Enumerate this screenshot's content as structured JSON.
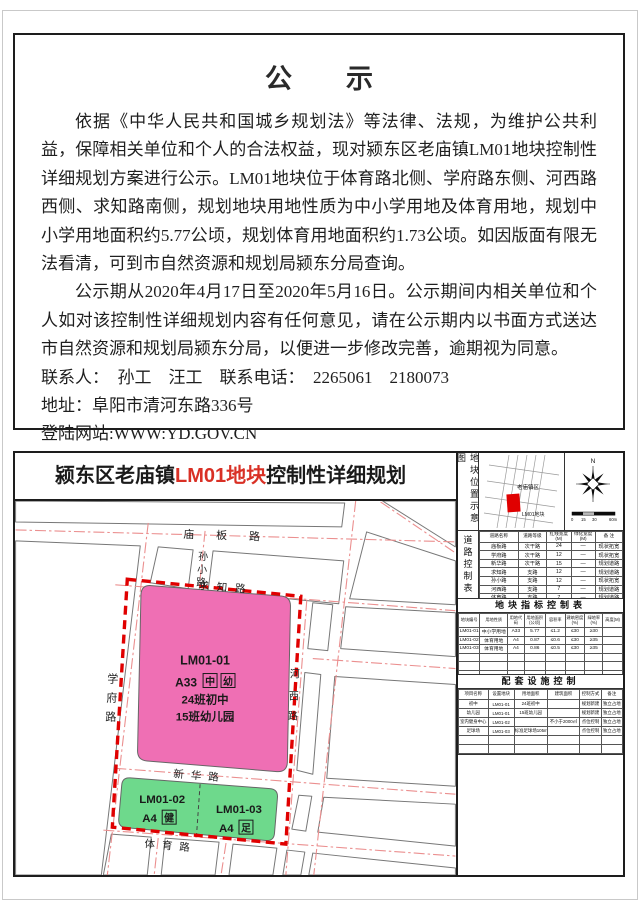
{
  "colors": {
    "parcel_pink": "#ef6fb4",
    "parcel_green": "#6ed98c",
    "boundary_red": "#e00000",
    "centerline_red": "#eb8f8f",
    "title_red": "#d93025",
    "minimap_plot_red": "#e00000"
  },
  "notice": {
    "title": "公　　示",
    "p1": "依据《中华人民共和国城乡规划法》等法律、法规，为维护公共利益，保障相关单位和个人的合法权益，现对颍东区老庙镇LM01地块控制性详细规划方案进行公示。LM01地块位于体育路北侧、学府路东侧、河西路西侧、求知路南侧，规划地块用地性质为中小学用地及体育用地，规划中小学用地面积约5.77公顷，规划体育用地面积约1.73公顷。如因版面有限无法看清，可到市自然资源和规划局颍东分局查询。",
    "p2": "公示期从2020年4月17日至2020年5月16日。公示期间内相关单位和个人如对该控制性详细规划内容有任何意见，请在公示期内以书面方式送达市自然资源和规划局颍东分局，以便进一步修改完善，逾期视为同意。",
    "contact_line": "联系人：　孙工　汪工　联系电话：　2265061　2180073",
    "address_line": "地址：阜阳市清河东路336号",
    "website_line": "登陆网站:WWW:YD.GOV.CN",
    "date": "2020年4月17日"
  },
  "plan": {
    "title_prefix": "颍东区老庙镇",
    "title_red": "LM01地块",
    "title_suffix": "控制性详细规划",
    "map": {
      "roads": {
        "miaoban": "庙板路",
        "sunxiao": "孙小路",
        "qiuzhi": "求知路",
        "xuefu": "学府路",
        "hexi": "河西路",
        "xinhua": "新华路",
        "tiyu": "体育路"
      },
      "parcels": {
        "p1": {
          "id": "LM01-01",
          "code": "A33",
          "box1": "中",
          "box2": "幼",
          "line1": "24班初中",
          "line2": "15班幼儿园"
        },
        "p2": {
          "id": "LM01-02",
          "code": "A4",
          "box1": "健"
        },
        "p3": {
          "id": "LM01-03",
          "code": "A4",
          "box1": "足"
        }
      }
    },
    "location_panel": {
      "vertical_label": "地块位置示意图",
      "town_label": "老庙镇区",
      "plot_label": "LM01地块",
      "north": "N",
      "scale_labels": [
        "0",
        "15",
        "30",
        "60m"
      ]
    },
    "road_table": {
      "vertical_label": "道路控制表",
      "header_rows": [
        [
          "道路名称",
          "道路等级",
          "红线宽度(M)",
          "绿化宽度(M)",
          "备  注"
        ]
      ],
      "rows": [
        [
          "庙板路",
          "次干路",
          "24",
          "—",
          "现状拓宽"
        ],
        [
          "学府路",
          "次干路",
          "12",
          "—",
          "现状拓宽"
        ],
        [
          "新华路",
          "次干路",
          "15",
          "—",
          "规划道路"
        ],
        [
          "求知路",
          "支路",
          "12",
          "—",
          "规划道路"
        ],
        [
          "孙小路",
          "支路",
          "12",
          "—",
          "现状拓宽"
        ],
        [
          "河西路",
          "支路",
          "7",
          "—",
          "规划道路"
        ],
        [
          "体育路",
          "支路",
          "7",
          "—",
          "规划道路"
        ]
      ]
    },
    "index_table": {
      "title": "地块指标控制表",
      "header_rows": [
        [
          "地块编号",
          "用地性质",
          "用地代码",
          "用地面积(公顷)",
          "容积率",
          "建筑密度(%)",
          "绿地率(%)",
          "高度(M)"
        ]
      ],
      "rows": [
        [
          "LM01-01",
          "中小学用地",
          "A33",
          "5.77",
          "≤1.2",
          "≤30",
          "≥30",
          ""
        ],
        [
          "LM01-02",
          "体育用地",
          "A4",
          "0.87",
          "≤0.6",
          "≤30",
          "≥35",
          ""
        ],
        [
          "LM01-03",
          "体育用地",
          "A4",
          "0.86",
          "≤0.5",
          "≤30",
          "≥35",
          ""
        ],
        [
          "",
          "",
          "",
          "",
          "",
          "",
          "",
          ""
        ],
        [
          "",
          "",
          "",
          "",
          "",
          "",
          "",
          ""
        ],
        [
          "",
          "",
          "",
          "",
          "",
          "",
          "",
          ""
        ],
        [
          "",
          "",
          "",
          "",
          "",
          "",
          "",
          ""
        ]
      ]
    },
    "facility_table": {
      "title": "配套设施控制",
      "header_rows": [
        [
          "项目名称",
          "设置地块",
          "用地面积",
          "建筑面积",
          "控制方式",
          "备注"
        ]
      ],
      "rows": [
        [
          "初中",
          "LM01-01",
          "24班初中",
          "",
          "规划新建",
          "独立占地"
        ],
        [
          "幼儿园",
          "LM01-01",
          "15班幼儿园",
          "",
          "规划新建",
          "独立占地"
        ],
        [
          "室内健身中心",
          "LM01-02",
          "",
          "不小于2000㎡",
          "点位控制",
          "独立占地"
        ],
        [
          "足球场",
          "LM01-03",
          "标准足球场105m×68m",
          "",
          "点位控制",
          "独立占地"
        ],
        [
          "",
          "",
          "",
          "",
          "",
          ""
        ],
        [
          "",
          "",
          "",
          "",
          "",
          ""
        ],
        [
          "",
          "",
          "",
          "",
          "",
          ""
        ]
      ]
    }
  }
}
